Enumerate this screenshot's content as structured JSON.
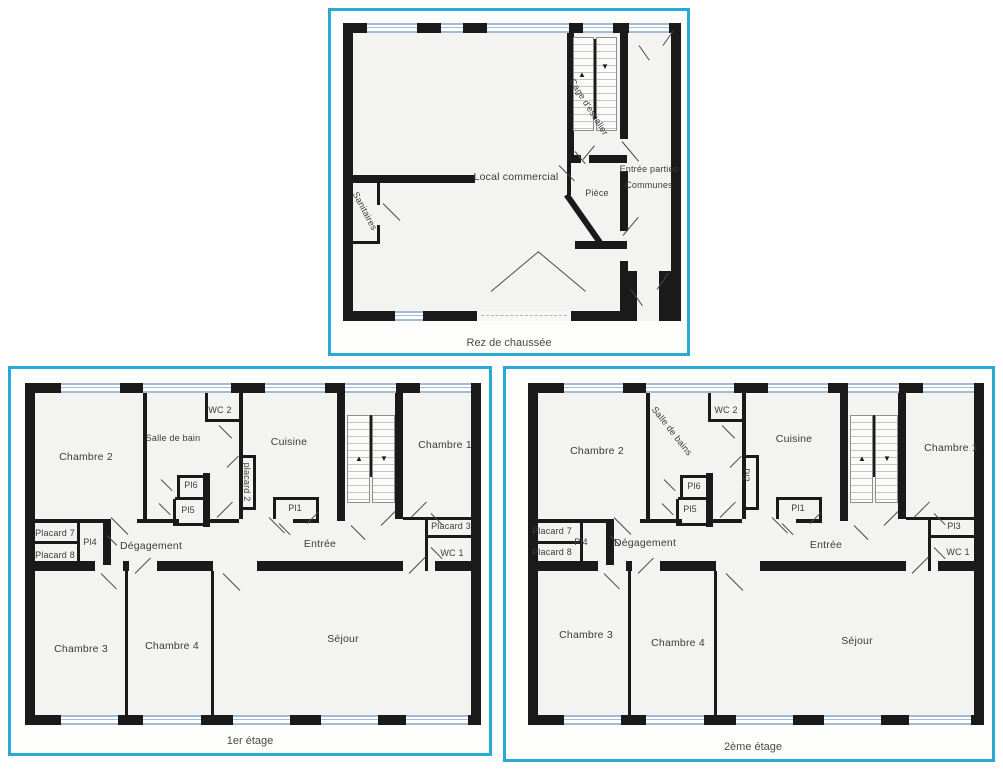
{
  "colors": {
    "frame": "#2aa9d4",
    "wall": "#1a1a1a",
    "window_symbol": "#a3bbd4",
    "floor": "#f3f3f1"
  },
  "icons": {
    "stair_up": "▲",
    "stair_down": "▼"
  },
  "plans": {
    "ground": {
      "caption": "Rez de chaussée",
      "rooms": {
        "local_commercial": "Local commercial",
        "sanitaires": "Sanitaires",
        "piece": "Pièce",
        "cage_escalier": "Cage d'escalier",
        "entree_parties": "Entrée parties",
        "communes": "Communes"
      }
    },
    "first": {
      "caption": "1er étage",
      "rooms": {
        "chambre1": "Chambre 1",
        "chambre2": "Chambre 2",
        "chambre3": "Chambre 3",
        "chambre4": "Chambre 4",
        "salle_de_bain": "Salle de bain",
        "wc1": "WC 1",
        "wc2": "WC 2",
        "cuisine": "Cuisine",
        "entree": "Entrée",
        "degagement": "Dégagement",
        "sejour": "Séjour",
        "pl1": "Pl1",
        "pl4": "Pl4",
        "pl5": "Pl5",
        "pl6": "Pl6",
        "placard2": "placard 2",
        "placard3": "Placard 3",
        "placard7": "Placard 7",
        "placard8": "Placard 8"
      }
    },
    "second": {
      "caption": "2ème étage",
      "rooms": {
        "chambre1": "Chambre 1",
        "chambre2": "Chambre 2",
        "chambre3": "Chambre 3",
        "chambre4": "Chambre 4",
        "salle_de_bains": "Salle de bains",
        "wc1": "WC 1",
        "wc2": "WC 2",
        "cuisine": "Cuisine",
        "entree": "Entrée",
        "degagement": "Dégagement",
        "sejour": "Séjour",
        "pl1": "Pl1",
        "pl2": "Pl2",
        "pl3": "Pl3",
        "pl4": "Pl4",
        "pl5": "Pl5",
        "pl6": "Pl6",
        "placard7": "Placard 7",
        "placard8": "Placard 8"
      }
    }
  }
}
